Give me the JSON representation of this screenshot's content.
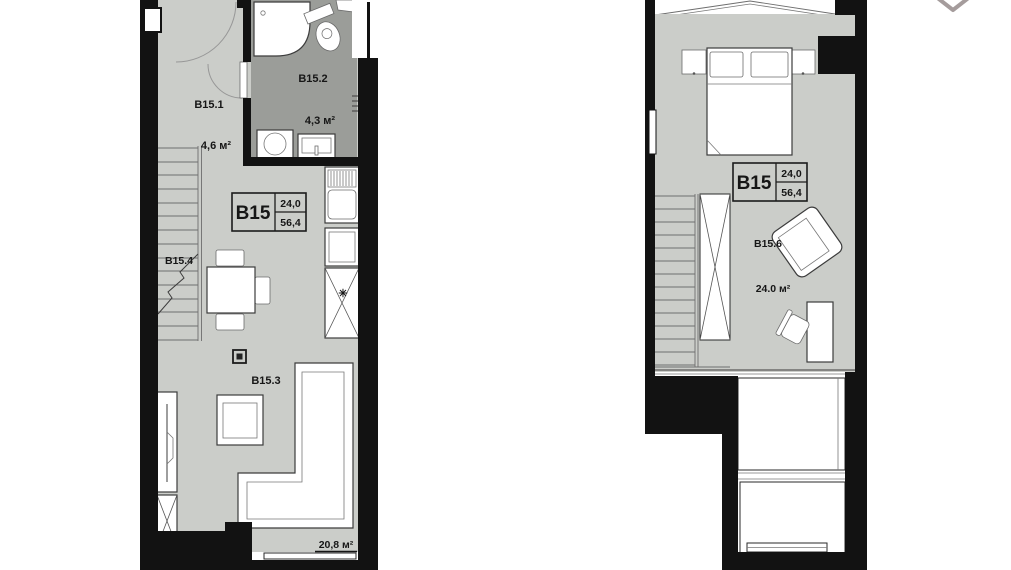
{
  "viewer": {
    "close_label": "close"
  },
  "colors": {
    "bg": "#ffffff",
    "wall": "#121212",
    "floor": "#cbcdc9",
    "bath": "#9b9d99",
    "line": "#3c3c3c",
    "icon": "#a59c9c"
  },
  "plan1": {
    "name": "lower-level-floor-plan",
    "card": {
      "unit": "B15",
      "value_top": "24,0",
      "value_bottom": "56,4"
    },
    "rooms": {
      "hall": {
        "id": "B15.1",
        "area": "4,6 м²"
      },
      "bathroom": {
        "id": "B15.2",
        "area": "4,3 м²"
      },
      "stairs": {
        "id": "B15.4"
      },
      "living": {
        "id": "B15.3",
        "area": "20,8 м²"
      }
    },
    "symbols": {
      "burner": "✳"
    }
  },
  "plan2": {
    "name": "upper-level-floor-plan",
    "card": {
      "unit": "B15",
      "value_top": "24,0",
      "value_bottom": "56,4"
    },
    "rooms": {
      "bedroom": {
        "id": "B15.6",
        "area": "24.0 м²"
      }
    }
  }
}
